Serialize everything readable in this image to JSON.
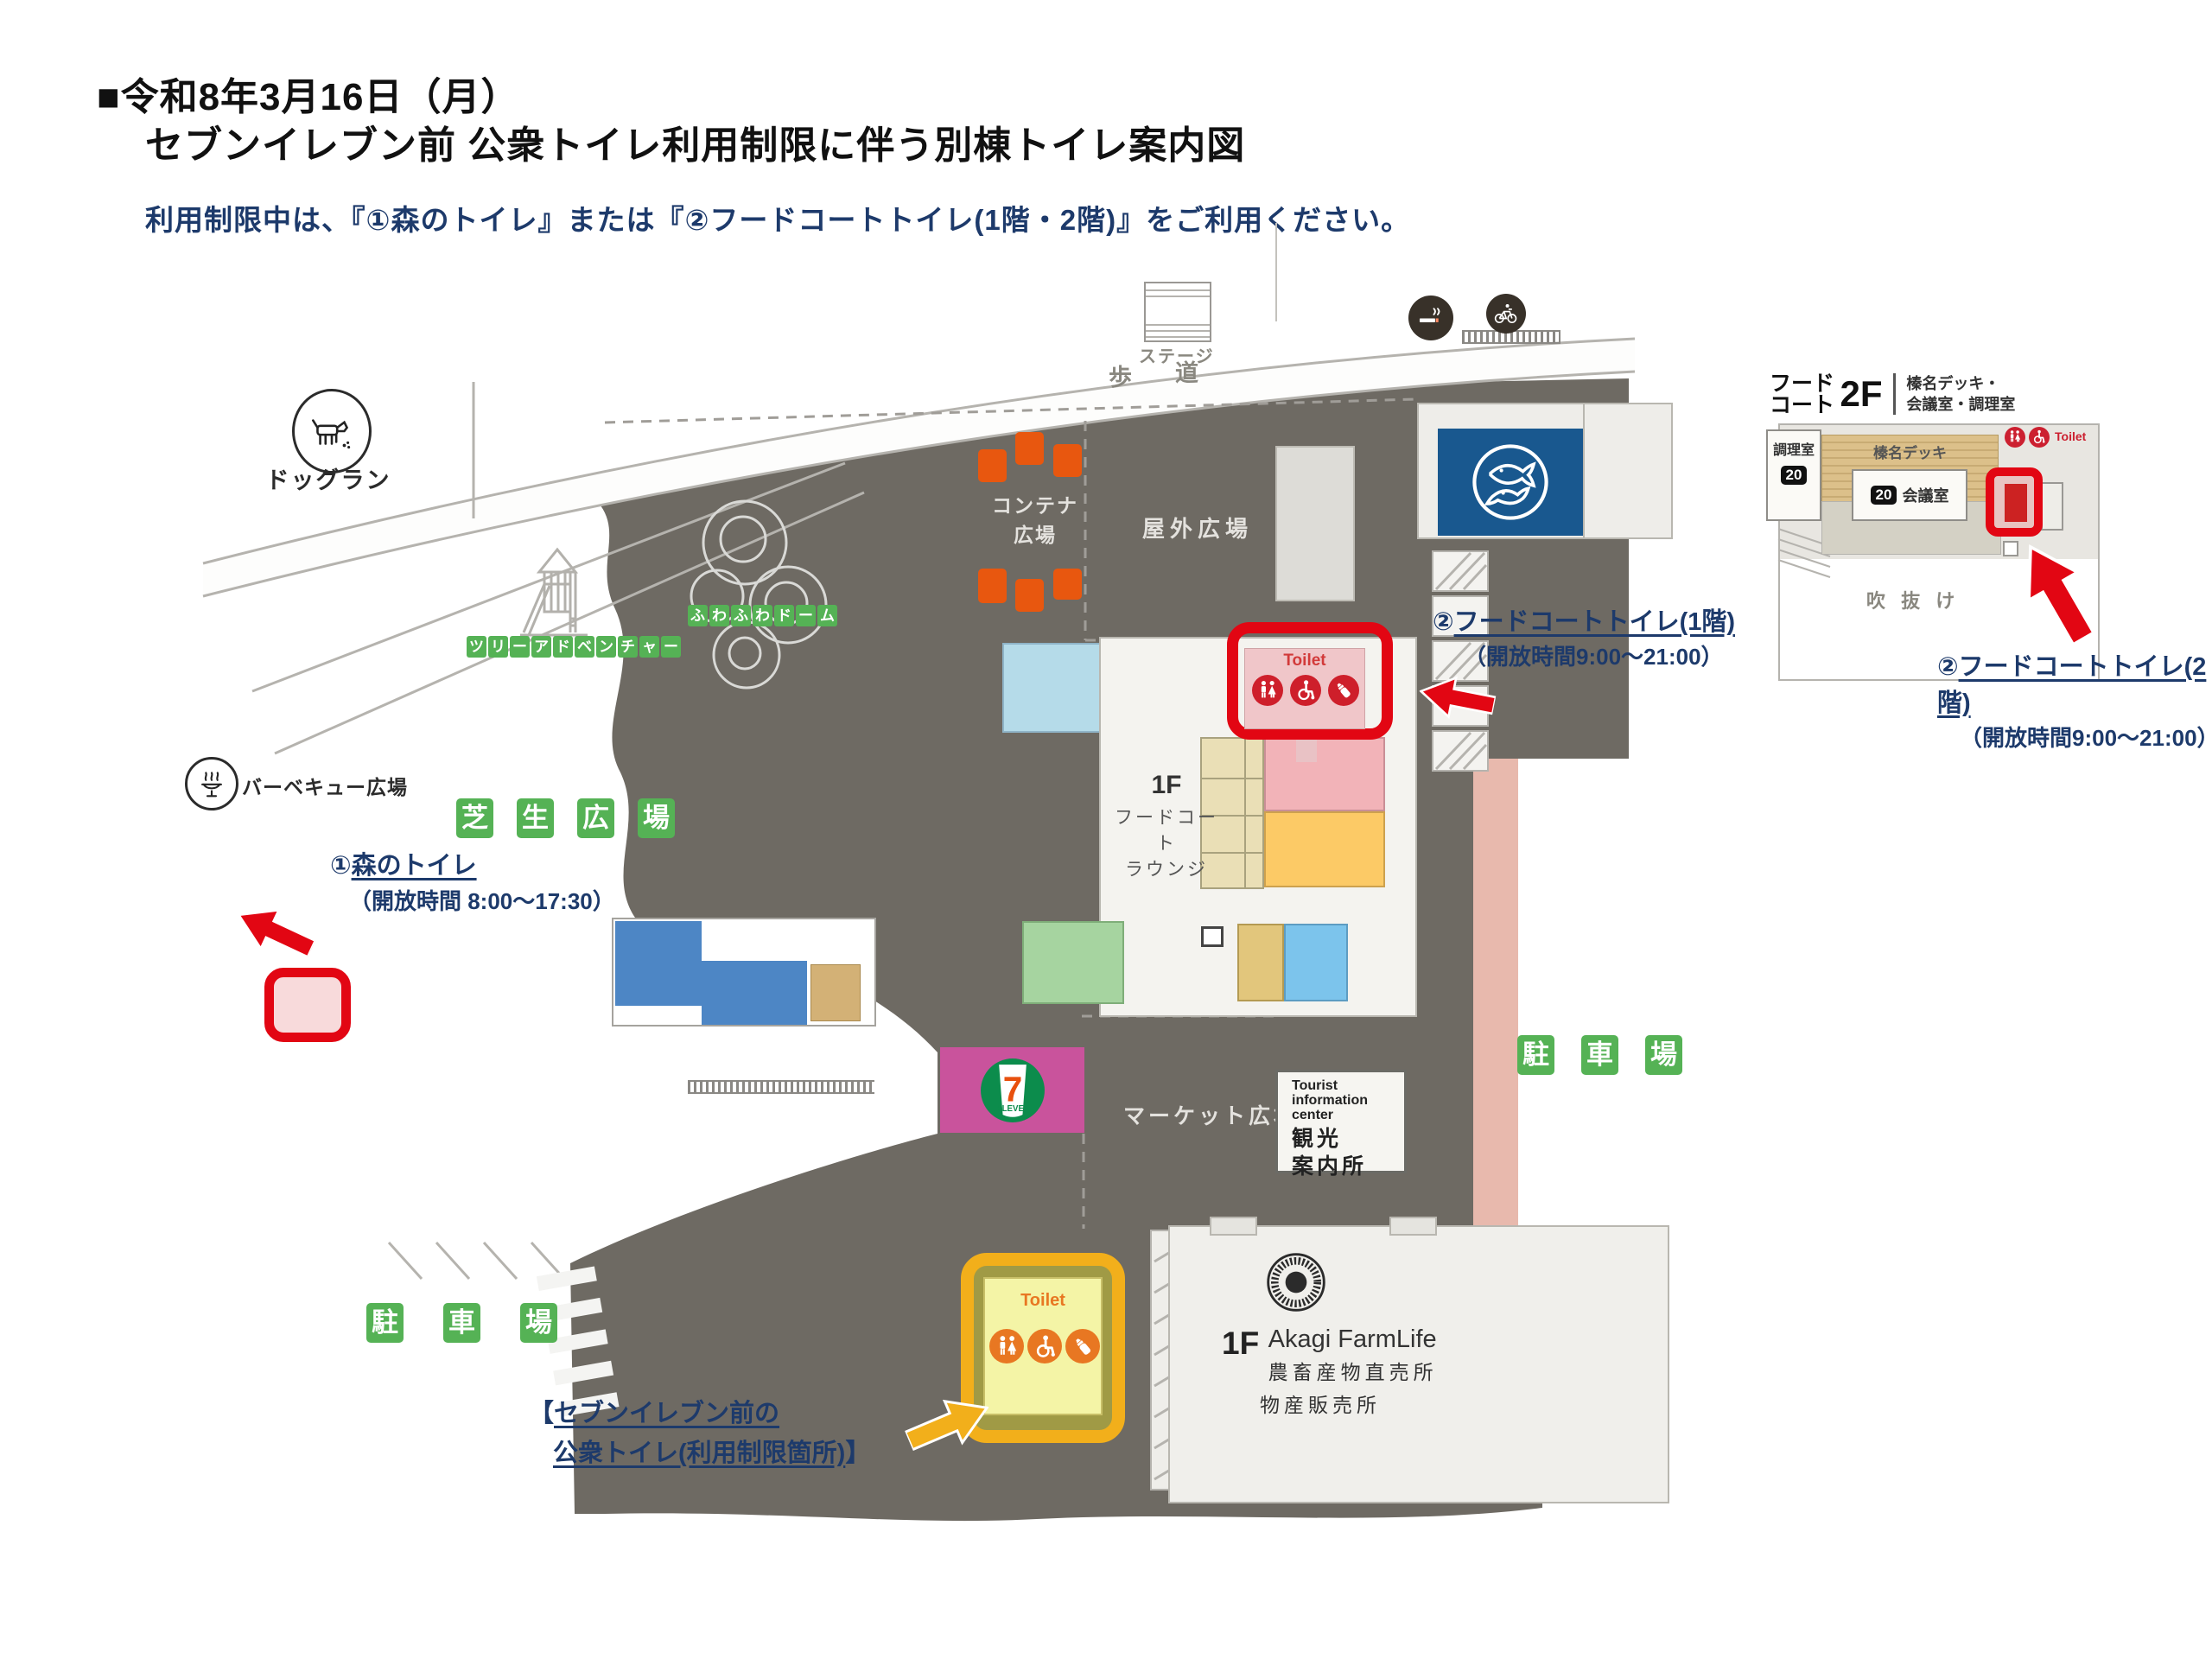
{
  "header": {
    "date_line": "■令和8年3月16日（月）",
    "title_line": "セブンイレブン前 公衆トイレ利用制限に伴う別棟トイレ案内図",
    "notice_line": "利用制限中は、『①森のトイレ』または『②フードコートトイレ(1階・2階)』をご利用ください。"
  },
  "map": {
    "stage": "ステージ",
    "walkway_char1": "歩",
    "walkway_char2": "道",
    "dog_run": "ドッグラン",
    "tree_adventure": "ツリーアドベンチャー",
    "fuwafuwa_dome": "ふわふわドーム",
    "bbq_plaza": "バーベキュー広場",
    "lawn_plaza": "芝生広場",
    "container_plaza_line1": "コンテナ",
    "container_plaza_line2": "広場",
    "outdoor_plaza": "屋外広場",
    "market_plaza": "マーケット広場",
    "parking": "駐車場",
    "food_court_floor": "1F",
    "food_court_line1": "フードコート",
    "food_court_line2": "ラウンジ",
    "toilet_sign": "Toilet",
    "tourist_info_en1": "Tourist",
    "tourist_info_en2": "information",
    "tourist_info_en3": "center",
    "tourist_info_ja1": "観光",
    "tourist_info_ja2": "案内所",
    "akagi_floor": "1F",
    "akagi_name": "Akagi FarmLife",
    "akagi_line1": "農畜産物直売所",
    "akagi_line2": "物産販売所",
    "seven_eleven_seven": "7",
    "seven_eleven_eleven": "ELEVEn"
  },
  "annotations": {
    "forest": {
      "num": "①",
      "title": "森のトイレ",
      "hours": "（開放時間 8:00～17:30）"
    },
    "fc1": {
      "num": "②",
      "title": "フードコートトイレ(1階)",
      "hours": "（開放時間9:00～21:00）"
    },
    "fc2": {
      "num": "②",
      "title": "フードコートトイレ(2階)",
      "hours": "（開放時間9:00～21:00）"
    },
    "restricted": {
      "open": "【",
      "line1": "セブンイレブン前の",
      "line2": "公衆トイレ(利用制限箇所)",
      "close": "】"
    }
  },
  "inset": {
    "title_line1": "フード",
    "title_line2": "コート",
    "floor": "2F",
    "subtitle_line1": "榛名デッキ・",
    "subtitle_line2": "会議室・調理室",
    "cooking_room": "調理室",
    "cooking_capacity": "20",
    "deck": "榛名デッキ",
    "meeting_capacity": "20",
    "meeting_room": "会議室",
    "toilet_sign": "Toilet",
    "atrium": "吹 抜 け"
  },
  "colors": {
    "accent_red": "#e20613",
    "accent_gold": "#f2af1b",
    "navy": "#1d3a6b",
    "plaza_gray": "#6e6a63",
    "label_green": "#55b255",
    "seven_magenta": "#c9539c",
    "fish_blue": "#19588f"
  }
}
